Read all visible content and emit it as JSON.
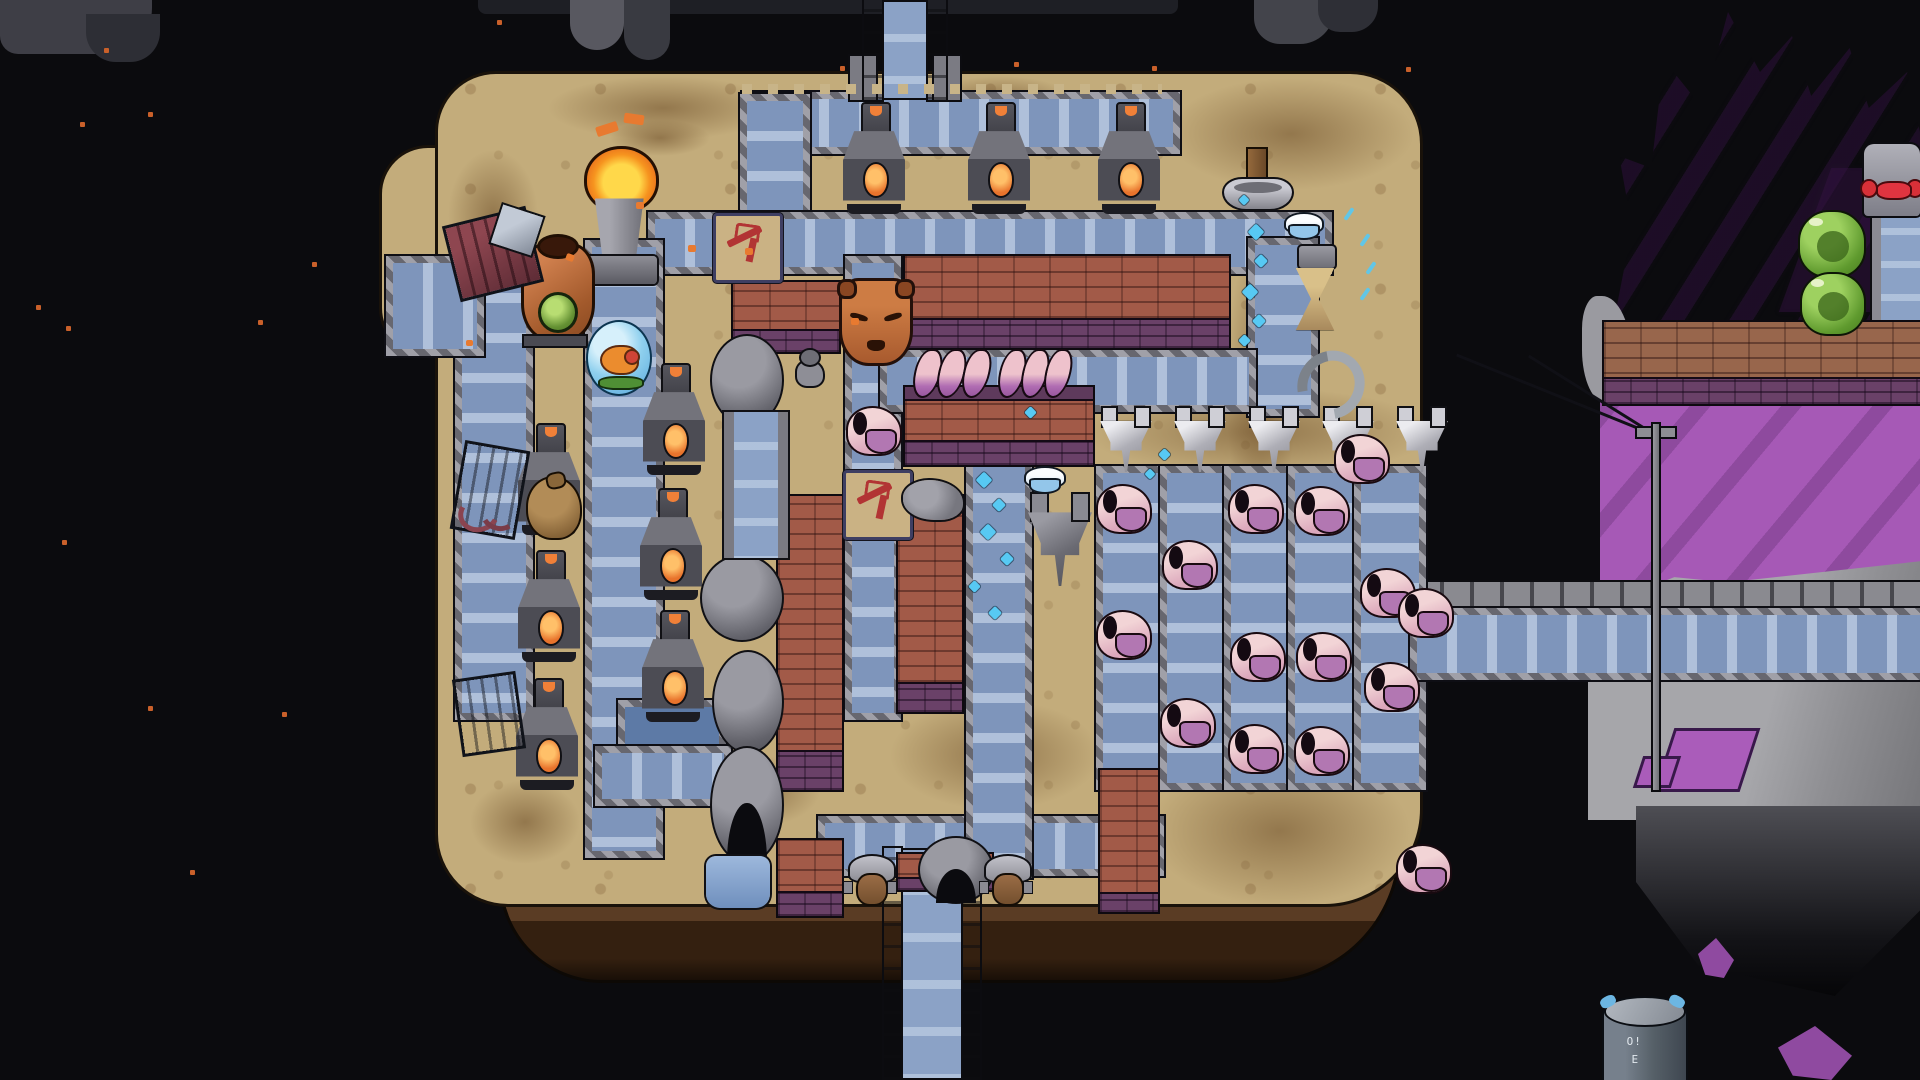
{
  "meta": {
    "scene": "pixel-art space factory on a floating island",
    "viewport": {
      "width": 1920,
      "height": 1080
    }
  },
  "labels": {
    "canister_mark_top": "O!",
    "canister_mark_bottom": "E"
  },
  "palette": {
    "space": "#0b0b0e",
    "island_tan": "#c3ac7b",
    "soil_brown": "#735436",
    "belt_blue": "#7e95bb",
    "belt_frame_grey": "#84848c",
    "furnace_grey": "#4c4c54",
    "fire_orange": "#f08038",
    "brick_red": "#a25a48",
    "brick_purple": "#6a4168",
    "crystal_purple": "#a35ab3",
    "slime_green": "#5f9a2e",
    "droplet_cyan": "#57c9f3",
    "sign_tan": "#cab284",
    "sign_icon_red": "#b23434"
  },
  "space": {
    "dust": [
      [
        104,
        48
      ],
      [
        80,
        122
      ],
      [
        148,
        112
      ],
      [
        36,
        305
      ],
      [
        66,
        326
      ],
      [
        312,
        262
      ],
      [
        258,
        320
      ],
      [
        148,
        706
      ],
      [
        190,
        870
      ],
      [
        282,
        712
      ],
      [
        840,
        66
      ],
      [
        1014,
        62
      ],
      [
        1152,
        66
      ],
      [
        1406,
        67
      ],
      [
        497,
        20
      ],
      [
        62,
        540
      ]
    ],
    "asteroids": [
      {
        "b": [
          0,
          0,
          152,
          54
        ],
        "c": "#3e3e46",
        "rad": "0 0 46px 18px"
      },
      {
        "b": [
          86,
          14,
          74,
          48
        ],
        "c": "#2d2e35",
        "rad": "0 0 30px 30px"
      },
      {
        "b": [
          478,
          0,
          700,
          14
        ],
        "c": "#1e1f25",
        "rad": "0 0 8px 8px"
      },
      {
        "b": [
          570,
          0,
          54,
          50
        ],
        "c": "#585860",
        "rad": "0 0 40px 40px"
      },
      {
        "b": [
          624,
          0,
          46,
          60
        ],
        "c": "#393a41",
        "rad": "0 0 22px 26px"
      },
      {
        "b": [
          1254,
          0,
          80,
          44
        ],
        "c": "#43444b",
        "rad": "0 0 34px 26px"
      },
      {
        "b": [
          1318,
          0,
          60,
          32
        ],
        "c": "#2e2f36",
        "rad": "0 0 26px 22px"
      }
    ]
  },
  "main_island": {
    "body": [
      438,
      74,
      982,
      830
    ],
    "bulge": [
      382,
      148,
      122,
      206
    ],
    "underside": [
      502,
      846,
      896,
      134
    ],
    "soil_patches": [
      [
        548,
        76,
        230,
        64
      ],
      [
        930,
        76,
        140,
        44
      ],
      [
        1168,
        78,
        246,
        112
      ],
      [
        448,
        150,
        90,
        130
      ],
      [
        1226,
        236,
        70,
        300
      ],
      [
        1150,
        756,
        260,
        150
      ],
      [
        470,
        780,
        110,
        84
      ],
      [
        890,
        700,
        210,
        110
      ],
      [
        610,
        120,
        100,
        36
      ],
      [
        1258,
        500,
        60,
        220
      ],
      [
        1086,
        388,
        348,
        88
      ],
      [
        700,
        756,
        120,
        70
      ]
    ]
  },
  "bridges": {
    "top": [
      850,
      0,
      110,
      100
    ],
    "bottom": [
      884,
      848,
      96,
      232
    ],
    "right_rail": [
      1410,
      582,
      510,
      30
    ],
    "mast": [
      1648,
      424,
      16,
      366
    ]
  },
  "conveyors": [
    [
      742,
      92,
      424,
      48,
      "h"
    ],
    [
      740,
      94,
      56,
      124,
      "v"
    ],
    [
      648,
      212,
      670,
      48,
      "h"
    ],
    [
      1248,
      238,
      56,
      164,
      "v"
    ],
    [
      845,
      256,
      42,
      100,
      "v"
    ],
    [
      845,
      346,
      42,
      194,
      "v"
    ],
    [
      880,
      350,
      362,
      48,
      "h"
    ],
    [
      845,
      530,
      42,
      176,
      "v"
    ],
    [
      455,
      256,
      64,
      450,
      "v"
    ],
    [
      585,
      240,
      64,
      604,
      "v"
    ],
    [
      386,
      256,
      84,
      86,
      "h"
    ],
    [
      618,
      700,
      94,
      56,
      "h",
      "liq"
    ],
    [
      595,
      746,
      122,
      46,
      "h"
    ],
    [
      818,
      816,
      332,
      46,
      "h"
    ],
    [
      966,
      456,
      52,
      408,
      "v"
    ],
    [
      1096,
      466,
      58,
      310,
      "v"
    ],
    [
      1160,
      466,
      58,
      310,
      "v"
    ],
    [
      1224,
      466,
      58,
      310,
      "v"
    ],
    [
      1288,
      466,
      58,
      310,
      "v"
    ],
    [
      1354,
      466,
      58,
      310,
      "v"
    ],
    [
      1410,
      608,
      510,
      58,
      "h"
    ]
  ],
  "walls": [
    [
      733,
      282,
      106,
      70,
      "red"
    ],
    [
      905,
      256,
      324,
      92,
      "red"
    ],
    [
      905,
      387,
      188,
      78,
      "redcap"
    ],
    [
      778,
      496,
      64,
      294,
      "redv"
    ],
    [
      898,
      496,
      64,
      216,
      "redv"
    ],
    [
      778,
      840,
      64,
      76,
      "red"
    ],
    [
      898,
      854,
      94,
      36,
      "red"
    ],
    [
      1100,
      770,
      58,
      142,
      "redv"
    ],
    [
      1604,
      322,
      316,
      82,
      "brown"
    ]
  ],
  "machines": {
    "furnaces": [
      [
        843,
        102
      ],
      [
        968,
        102
      ],
      [
        1098,
        102
      ],
      [
        518,
        423
      ],
      [
        518,
        550
      ],
      [
        516,
        678
      ],
      [
        643,
        363
      ],
      [
        640,
        488
      ],
      [
        642,
        610
      ]
    ],
    "hoppers": {
      "y": 408,
      "xs": [
        1100,
        1174,
        1248,
        1322,
        1396
      ]
    },
    "dark_hopper": [
      1028,
      494,
      64,
      92
    ],
    "domes": [
      {
        "t": "dome",
        "b": [
          710,
          334,
          70,
          88
        ]
      },
      {
        "t": "dome",
        "b": [
          700,
          554,
          80,
          84
        ]
      },
      {
        "t": "dome",
        "b": [
          712,
          650,
          68,
          100
        ]
      },
      {
        "t": "domearch",
        "b": [
          710,
          746,
          70,
          114
        ]
      },
      {
        "t": "domearch",
        "b": [
          918,
          836,
          72,
          64
        ]
      }
    ],
    "pipe": [
      724,
      412,
      44,
      146
    ],
    "torch": [
      583,
      146,
      74,
      138
    ],
    "clay_vessel": [
      518,
      234,
      74,
      112
    ],
    "pedestal": [
      1222,
      146,
      68,
      68
    ],
    "hourglass": [
      1294,
      244,
      42,
      92
    ],
    "arch_item": [
      1298,
      350,
      46,
      50
    ],
    "elevator": [
      1872,
      202,
      48,
      130
    ],
    "red_light_machine": [
      1864,
      144,
      56,
      72
    ]
  },
  "items": {
    "signs": [
      [
        713,
        213
      ],
      [
        843,
        470
      ]
    ],
    "bowls": [
      [
        1284,
        212,
        36,
        28
      ],
      [
        1024,
        466,
        38,
        28
      ]
    ],
    "crates": [
      {
        "b": [
          453,
          218,
          80,
          72
        ],
        "r": -14,
        "v": "maroon"
      },
      {
        "b": [
          460,
          448,
          60,
          84
        ],
        "r": 10
      },
      {
        "b": [
          460,
          678,
          58,
          72
        ],
        "r": -8
      }
    ],
    "lid": [
      496,
      210,
      42,
      40
    ],
    "sack": [
      526,
      476,
      52,
      60
    ],
    "shards": [
      458,
      492,
      62,
      34
    ],
    "bubble": [
      586,
      320,
      62,
      72
    ],
    "rubble": [
      903,
      480,
      60,
      40
    ],
    "pool": [
      706,
      856,
      64,
      52
    ],
    "canister": [
      1602,
      996,
      82,
      84
    ],
    "shrimp": [
      [
        846,
        406
      ],
      [
        1096,
        484
      ],
      [
        1162,
        540
      ],
      [
        1096,
        610
      ],
      [
        1160,
        698
      ],
      [
        1228,
        484
      ],
      [
        1230,
        632
      ],
      [
        1228,
        724
      ],
      [
        1294,
        486
      ],
      [
        1296,
        632
      ],
      [
        1294,
        726
      ],
      [
        1334,
        434
      ],
      [
        1360,
        568
      ],
      [
        1364,
        662
      ],
      [
        1398,
        588
      ],
      [
        1396,
        844
      ]
    ],
    "shrimp_bunches": [
      [
        913,
        348,
        74,
        48
      ],
      [
        998,
        348,
        70,
        48
      ]
    ]
  },
  "creatures": {
    "statue_head": [
      839,
      278,
      68,
      82
    ],
    "worker_bugs": [
      [
        845,
        854,
        50,
        54
      ],
      [
        981,
        854,
        50,
        54
      ]
    ],
    "wall_bug": [
      792,
      348,
      32,
      38
    ],
    "slimes": [
      [
        1798,
        210,
        64,
        64
      ],
      [
        1800,
        272,
        62,
        60
      ]
    ]
  },
  "right_island": {
    "crystal": [
      1600,
      0,
      320,
      600
    ],
    "purple_band": [
      1600,
      392,
      320,
      200
    ],
    "rock_band": [
      1588,
      556,
      332,
      264
    ],
    "rock_dark": [
      1636,
      806,
      284,
      190
    ],
    "left_rock": [
      1582,
      296,
      50,
      108
    ],
    "inclusions": [
      [
        1664,
        728,
        80,
        58
      ],
      [
        1638,
        756,
        32,
        26
      ]
    ],
    "small_crystals": [
      [
        1698,
        938,
        36,
        40
      ],
      [
        1778,
        1026,
        74,
        54
      ]
    ]
  },
  "effects": {
    "droplets": [
      [
        1250,
        226,
        12
      ],
      [
        1256,
        256,
        10
      ],
      [
        1244,
        286,
        12
      ],
      [
        1254,
        316,
        10
      ],
      [
        1240,
        336,
        9
      ],
      [
        978,
        474,
        12
      ],
      [
        994,
        500,
        10
      ],
      [
        982,
        526,
        12
      ],
      [
        1002,
        554,
        10
      ],
      [
        970,
        582,
        9
      ],
      [
        990,
        608,
        10
      ],
      [
        1160,
        450,
        9
      ],
      [
        1146,
        470,
        8
      ],
      [
        1026,
        408,
        9
      ],
      [
        1240,
        196,
        8
      ]
    ],
    "cyan_dashes": [
      [
        1342,
        212
      ],
      [
        1358,
        238
      ],
      [
        1364,
        266
      ],
      [
        1358,
        292
      ]
    ],
    "sparks": [
      [
        566,
        254,
        8,
        7,
        20
      ],
      [
        636,
        202,
        8,
        7,
        0
      ],
      [
        688,
        245,
        8,
        7,
        0
      ],
      [
        745,
        248,
        8,
        7,
        0
      ],
      [
        851,
        318,
        8,
        7,
        0
      ],
      [
        466,
        340,
        7,
        6,
        0
      ],
      [
        596,
        124,
        22,
        10,
        -18
      ],
      [
        624,
        114,
        20,
        10,
        8
      ]
    ],
    "post_rows": [
      [
        742,
        84,
        420,
        10
      ],
      [
        888,
        340,
        340,
        10
      ]
    ]
  }
}
